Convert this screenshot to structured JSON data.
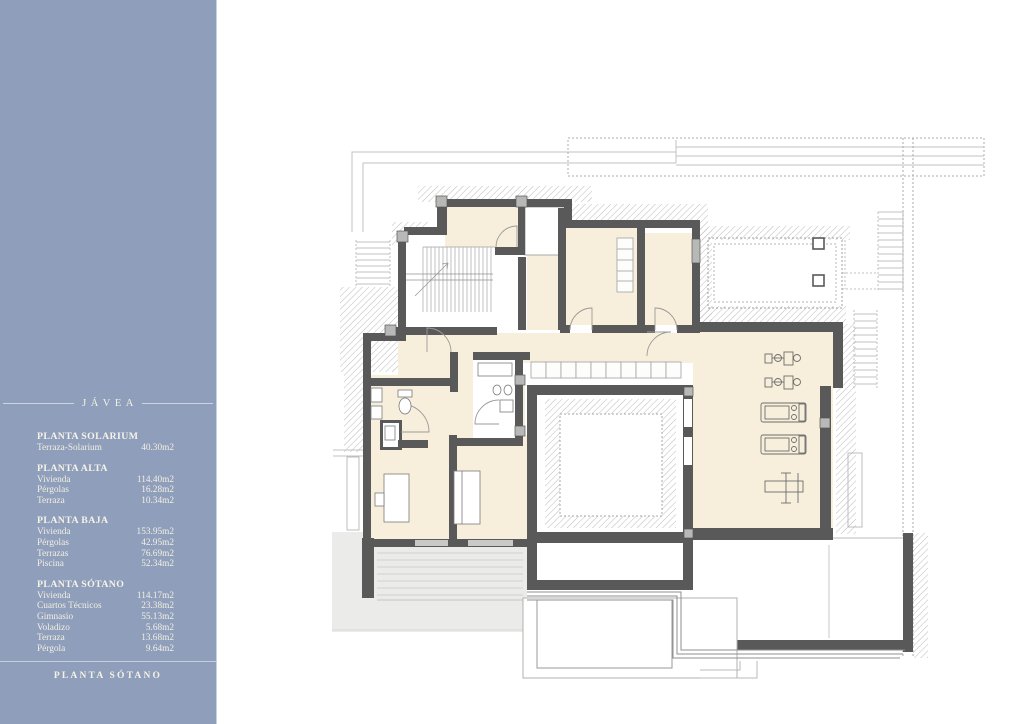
{
  "sidebar": {
    "title": "JÁVEA",
    "sections": [
      {
        "title": "PLANTA SOLARIUM",
        "rows": [
          {
            "label": "Terraza-Solarium",
            "value": "40.30m2"
          }
        ]
      },
      {
        "title": "PLANTA ALTA",
        "rows": [
          {
            "label": "Vivienda",
            "value": "114.40m2"
          },
          {
            "label": "Pérgolas",
            "value": "16.28m2"
          },
          {
            "label": "Terraza",
            "value": "10.34m2"
          }
        ]
      },
      {
        "title": "PLANTA BAJA",
        "rows": [
          {
            "label": "Vivienda",
            "value": "153.95m2"
          },
          {
            "label": "Pérgolas",
            "value": "42.95m2"
          },
          {
            "label": "Terrazas",
            "value": "76.69m2"
          },
          {
            "label": "Piscina",
            "value": "52.34m2"
          }
        ]
      },
      {
        "title": "PLANTA SÓTANO",
        "rows": [
          {
            "label": "Vivienda",
            "value": "114.17m2"
          },
          {
            "label": "Cuartos Técnicos",
            "value": "23.38m2"
          },
          {
            "label": "Gimnasio",
            "value": "55.13m2"
          },
          {
            "label": "Voladizo",
            "value": "5.68m2"
          },
          {
            "label": "Terraza",
            "value": "13.68m2"
          },
          {
            "label": "Pérgola",
            "value": "9.64m2"
          }
        ]
      }
    ],
    "footer": "PLANTA SÓTANO"
  },
  "plan": {
    "drawing": "floor-plan-planta-sotano",
    "colors": {
      "sidebar_bg": "#8E9EBB",
      "wall": "#59595A",
      "floor_cream": "#F7EFDC",
      "terrace_gray": "#EBEBEA",
      "hatch_line": "#B3B3B3"
    }
  }
}
